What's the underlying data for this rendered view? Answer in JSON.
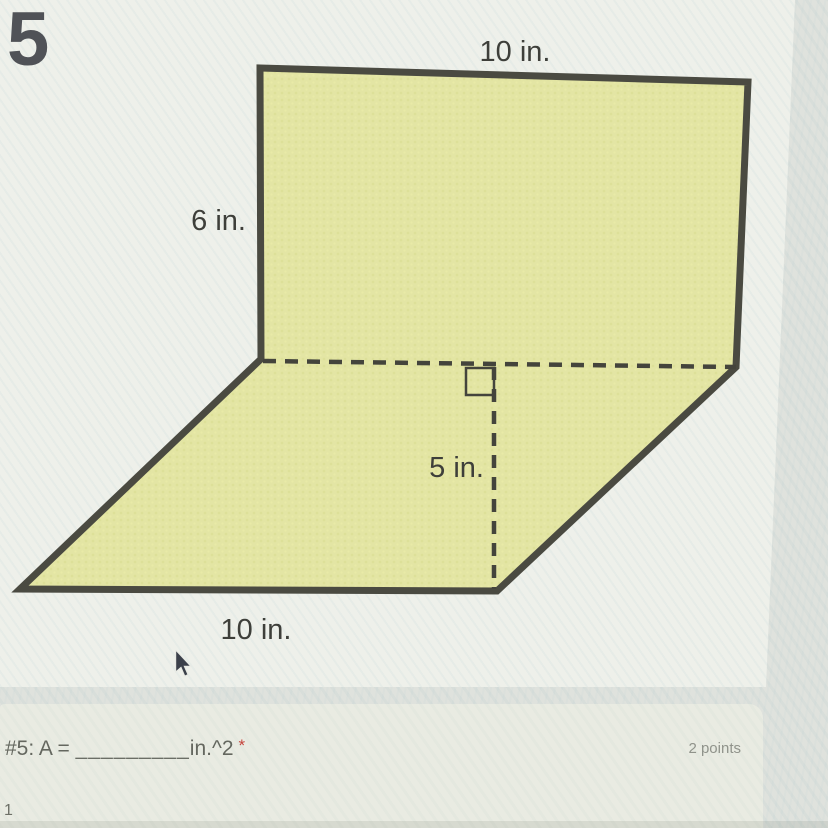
{
  "page": {
    "question_number": "5"
  },
  "figure": {
    "type": "composite-shape-area-diagram",
    "description": "Hexagonal composite figure: a rectangle on top joined to a slanted parallelogram below, separated by a dashed line, with a dashed height and right-angle mark",
    "fill_color": "#e3e5a4",
    "stroke_color": "#4a4a41",
    "labels": {
      "top_width": "10 in.",
      "left_height": "6 in.",
      "inner_height": "5 in.",
      "bottom_width": "10 in."
    }
  },
  "question_card": {
    "prompt_prefix": "#5: A = ",
    "blank": "_________",
    "prompt_suffix": "in.^2",
    "required_marker": "*",
    "points_label": "2 points",
    "answer_value": "1",
    "required_color": "#c5443c"
  }
}
